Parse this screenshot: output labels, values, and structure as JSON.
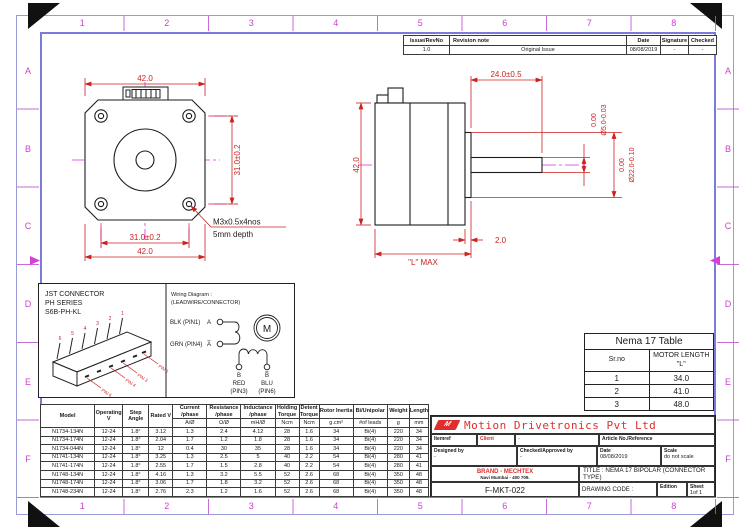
{
  "colors": {
    "frame_blue": "#7b7bd9",
    "ruler_magenta": "#cc3fd0",
    "centerline_magenta": "#e02ce0",
    "dimension_red": "#cc2222",
    "brand_red": "#dd2f2f",
    "drawing_black": "#1c1c1c"
  },
  "frame": {
    "top_numbers": [
      "1",
      "2",
      "3",
      "4",
      "5",
      "6",
      "7",
      "8"
    ],
    "bottom_numbers": [
      "1",
      "2",
      "3",
      "4",
      "5",
      "6",
      "7",
      "8"
    ],
    "left_letters": [
      "A",
      "B",
      "C",
      "D",
      "E",
      "F"
    ],
    "right_letters": [
      "A",
      "B",
      "C",
      "D",
      "E",
      "F"
    ]
  },
  "revision_table": {
    "headers": [
      "Issue/RevNo",
      "Revision note",
      "Date",
      "Signature",
      "Checked"
    ],
    "rows": [
      [
        "1.0",
        "Original Issue",
        "08/08/2019",
        "-",
        "-"
      ]
    ]
  },
  "front_view": {
    "dim_width_top": "42.0",
    "dim_hole_vertical": "31.0±0.2",
    "dim_hole_horizontal": "31.0±0.2",
    "dim_width_bottom": "42.0",
    "thread_callout_line1": "M3x0.5x4nos",
    "thread_callout_line2": "5mm depth"
  },
  "side_view": {
    "dim_shaft_length": "24.0±0.5",
    "shaft_dia_tol_upper": "0.00",
    "shaft_dia": "Ø5.0-0.03",
    "boss_dia_tol_upper": "0.00",
    "boss_dia": "Ø22.0-0.10",
    "dim_height": "42.0",
    "dim_body_length": "\"L\" MAX",
    "dim_boss_thickness": "2.0"
  },
  "connector_box": {
    "title_line1": "JST CONNECTOR",
    "title_line2": "PH SERIES",
    "title_line3": "S6B-PH-KL",
    "pin_numbers": [
      "6",
      "5",
      "4",
      "3",
      "2",
      "1"
    ],
    "pin_leader_labels": [
      "PIN 6",
      "PIN 4",
      "PIN 3",
      "PIN 1"
    ]
  },
  "wiring_diagram": {
    "title_line1": "Wiring Diagram :",
    "title_line2": "(LEADWIRE/CONNECTOR)",
    "lead_a_wire": "BLK (PIN1)",
    "lead_a_terminal": "A",
    "lead_abar_wire": "GRN (PIN4)",
    "lead_abar_terminal": "A̅",
    "motor_symbol": "M",
    "terminal_b": "B",
    "terminal_bbar": "B̅",
    "lead_b_wire": "RED",
    "lead_b_pin": "(PIN3)",
    "lead_bbar_wire": "BLU",
    "lead_bbar_pin": "(PIN6)"
  },
  "spec_table": {
    "headers": [
      "Model",
      "Operating V",
      "Step Angle",
      "Rated V",
      "Current /phase",
      "Resistance /phase",
      "Inductance /phase",
      "Holding Torque",
      "Detent Torque",
      "Rotor Inertia",
      "Bi/Unipolar",
      "Weight",
      "Length"
    ],
    "units": [
      "A/Ø",
      "Ω/Ø",
      "mH/Ø",
      "Ncm",
      "Ncm",
      "g.cm²",
      "#of leads",
      "g",
      "mm"
    ],
    "rows": [
      [
        "N1734-134N",
        "12-24",
        "1.8°",
        "3.12",
        "1.3",
        "2.4",
        "4.12",
        "28",
        "1.6",
        "34",
        "Bi(4)",
        "220",
        "34"
      ],
      [
        "N1734-174N",
        "12-24",
        "1.8°",
        "2.04",
        "1.7",
        "1.2",
        "1.8",
        "28",
        "1.6",
        "34",
        "Bi(4)",
        "220",
        "34"
      ],
      [
        "N1734-044N",
        "12-24",
        "1.8°",
        "12",
        "0.4",
        "30",
        "35",
        "28",
        "1.6",
        "34",
        "Bi(4)",
        "220",
        "34"
      ],
      [
        "N1741-134N",
        "12-24",
        "1.8°",
        "3.25",
        "1.3",
        "2.5",
        "5",
        "40",
        "2.2",
        "54",
        "Bi(4)",
        "280",
        "41"
      ],
      [
        "N1741-174N",
        "12-24",
        "1.8°",
        "2.55",
        "1.7",
        "1.5",
        "2.8",
        "40",
        "2.2",
        "54",
        "Bi(4)",
        "280",
        "41"
      ],
      [
        "N1748-134N",
        "12-24",
        "1.8°",
        "4.16",
        "1.3",
        "3.2",
        "5.5",
        "52",
        "2.6",
        "68",
        "Bi(4)",
        "350",
        "48"
      ],
      [
        "N1748-174N",
        "12-24",
        "1.8°",
        "3.06",
        "1.7",
        "1.8",
        "3.2",
        "52",
        "2.6",
        "68",
        "Bi(4)",
        "350",
        "48"
      ],
      [
        "N1748-234N",
        "12-24",
        "1.8°",
        "2.76",
        "2.3",
        "1.2",
        "1.6",
        "52",
        "2.6",
        "68",
        "Bi(4)",
        "350",
        "48"
      ]
    ]
  },
  "nema_table": {
    "title": "Nema 17 Table",
    "headers": [
      "Sr.no",
      "MOTOR LENGTH \"L\""
    ],
    "rows": [
      [
        "1",
        "34.0"
      ],
      [
        "2",
        "41.0"
      ],
      [
        "3",
        "48.0"
      ]
    ]
  },
  "title_block": {
    "company": "Motion Drivetronics Pvt Ltd",
    "logo_letter": "M",
    "itemref_label": "Itemref",
    "client_label": "Client",
    "client_value": "-",
    "article_label": "Article No./Reference",
    "designed_label": "Designed by",
    "designed_value": "-",
    "checked_label": "Checked/Approved by",
    "checked_value": "-",
    "date_label": "Date",
    "date_value": "08/08/2019",
    "scale_label": "Scale",
    "scale_value": "do not scale",
    "brand_line1": "BRAND - MECHTEX",
    "brand_line2": "Navi Mumbai - 400 709.",
    "title_text": "TITLE : NEMA 17 BIPOLAR (CONNECTOR TYPE)",
    "document_code": "F-MKT-022",
    "drawing_code_label": "DRAWING CODE :",
    "edition_label": "Edition",
    "sheet_label": "Sheet",
    "sheet_value": "1of 1"
  }
}
